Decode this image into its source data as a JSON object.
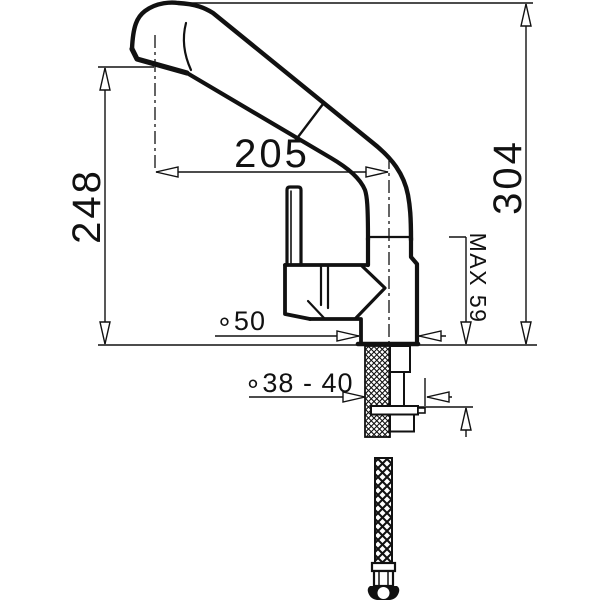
{
  "labels": {
    "spout_reach": "205",
    "outlet_height": "248",
    "total_height": "304",
    "max_mounting_thickness": "MAX 59",
    "base_diameter": "∘50",
    "mounting_hole_diameter": "∘38 - 40"
  },
  "colors": {
    "line": "#111111",
    "background": "#ffffff"
  }
}
